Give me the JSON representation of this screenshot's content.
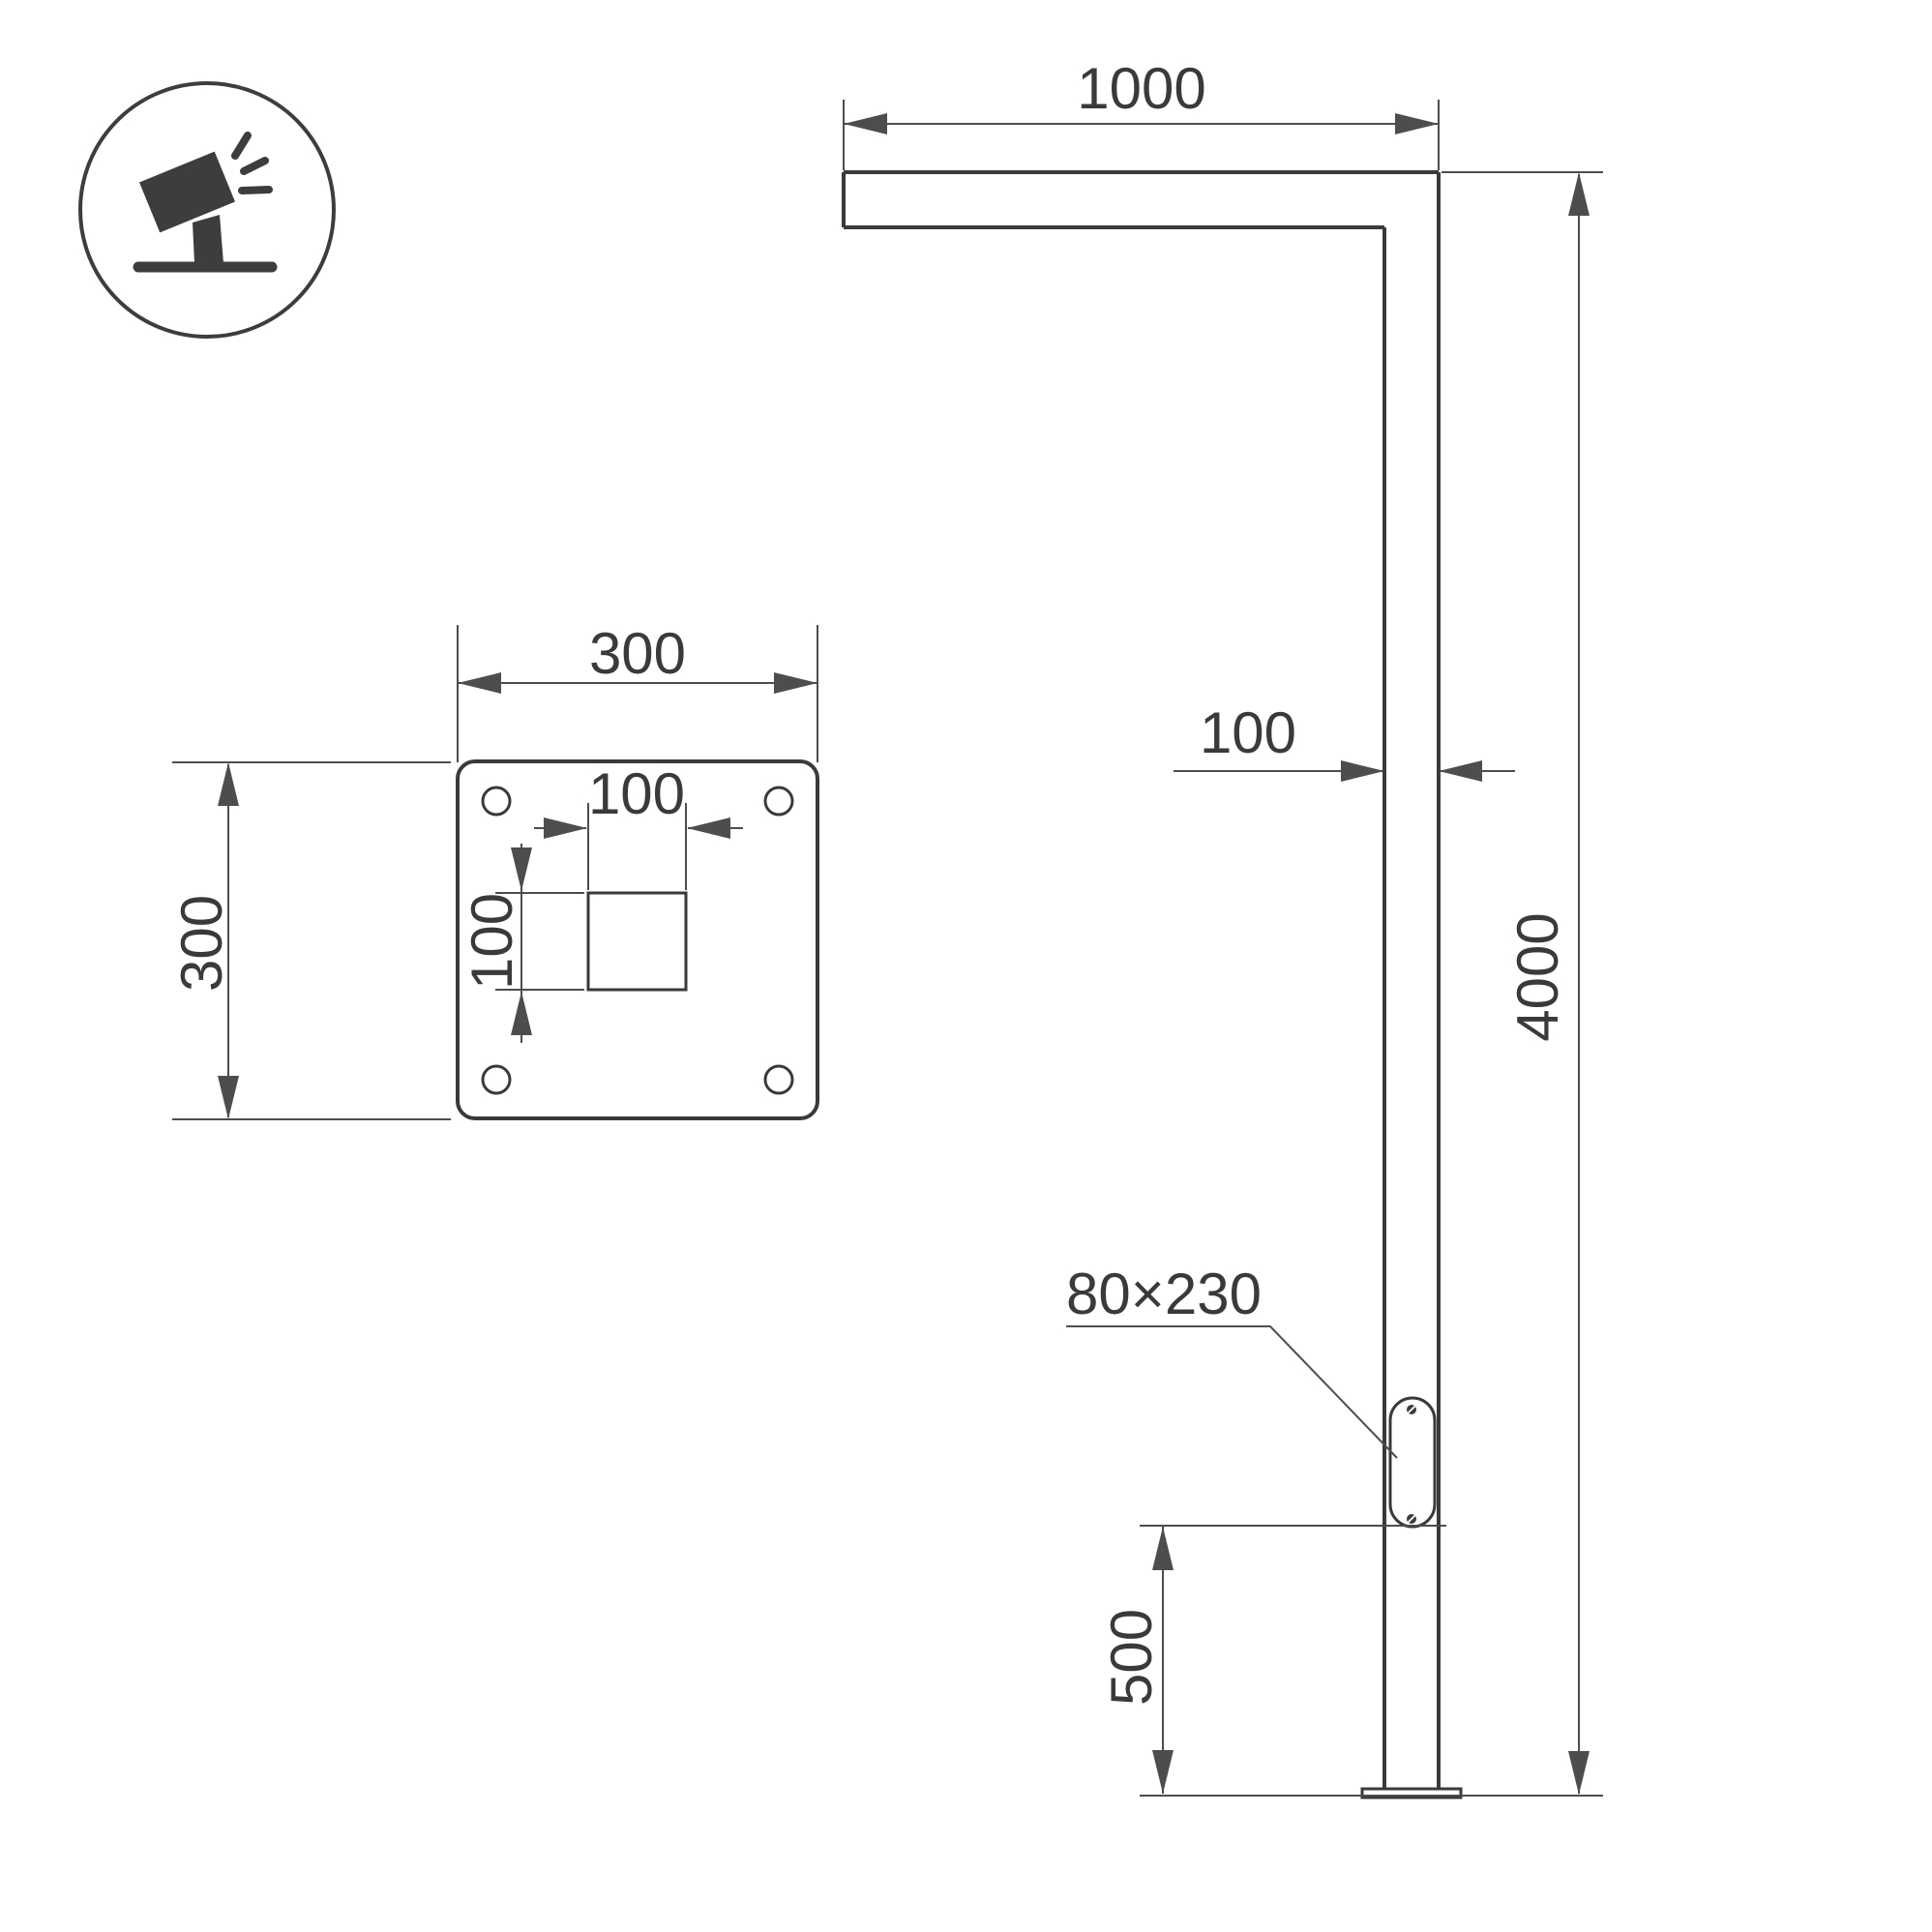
{
  "colors": {
    "bg": "#ffffff",
    "outline": "#3a3a3a",
    "dimension": "#4d4d4d",
    "text": "#3a3a3a",
    "icon": "#3d3d3d"
  },
  "icon": {
    "name": "tilted-floodlight-on-pole"
  },
  "pole_view": {
    "arm_length_label": "1000",
    "pole_width_label": "100",
    "pole_height_label": "4000",
    "panel_offset_label": "500",
    "access_panel_label": "80×230"
  },
  "plate_view": {
    "width_label": "300",
    "height_label": "300",
    "hole_width_label": "100",
    "hole_height_label": "100"
  }
}
